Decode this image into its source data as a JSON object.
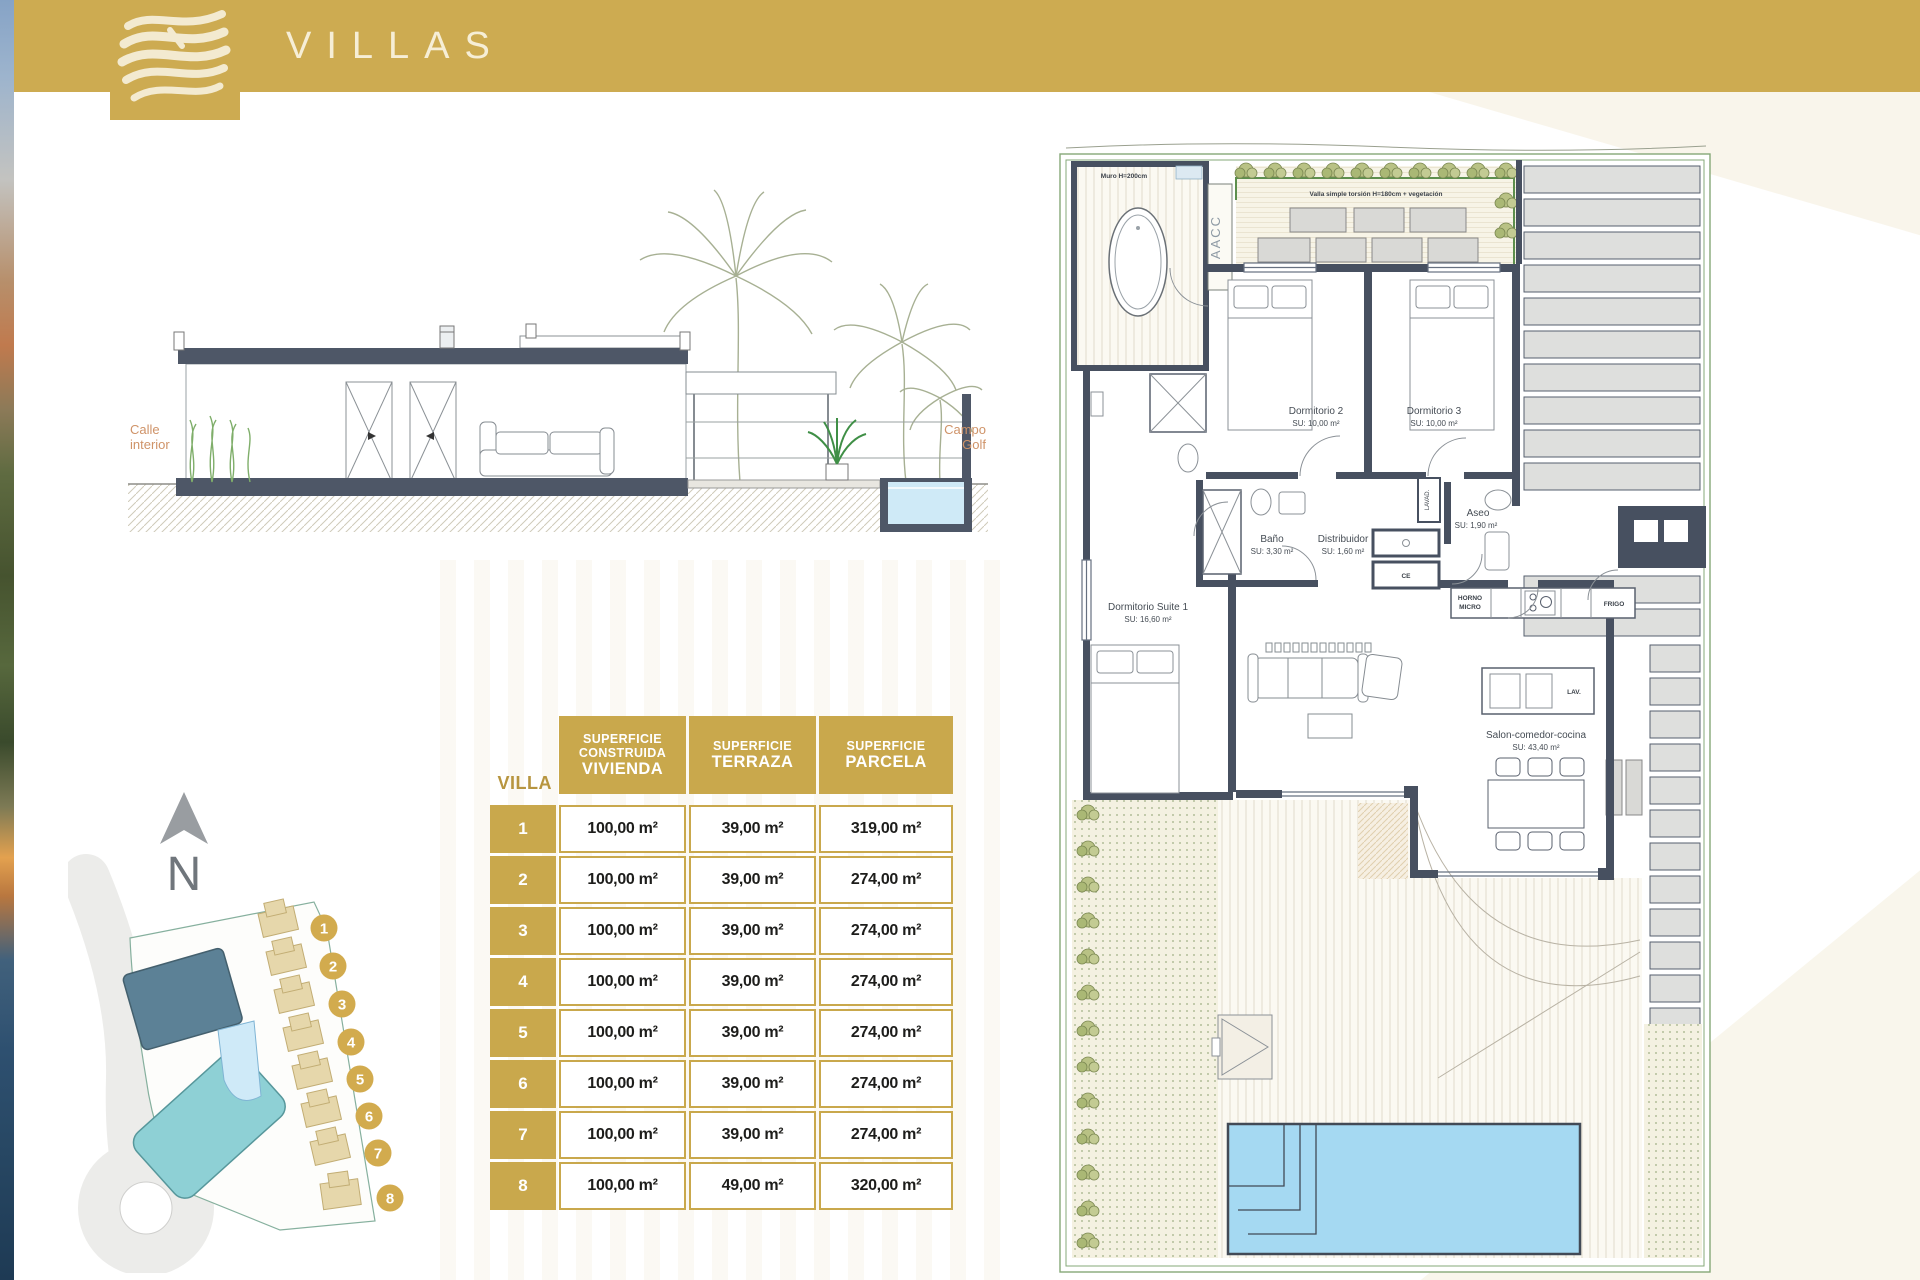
{
  "colors": {
    "gold": "#CDAB51",
    "table_gold": "#C9A84C",
    "wall_dark": "#475060",
    "pool_blue": "#A5D9F2",
    "fence_green": "#5D8F4D",
    "label_tan": "#CF9368",
    "site_building_dark": "#5C8196",
    "site_building_teal": "#8ED0D5",
    "villa_tan": "#E6D7AB"
  },
  "header": {
    "brand": "VILLAS"
  },
  "elevation": {
    "calle_l1": "Calle",
    "calle_l2": "interior",
    "campo_l1": "Campo",
    "campo_l2": "Golf"
  },
  "site_plan": {
    "north": "N",
    "plots": [
      "1",
      "2",
      "3",
      "4",
      "5",
      "6",
      "7",
      "8"
    ]
  },
  "table": {
    "villa_header": "VILLA",
    "col_vivienda": {
      "l1": "SUPERFICIE",
      "l2": "CONSTRUIDA",
      "l3": "VIVIENDA"
    },
    "col_terraza": {
      "l1": "SUPERFICIE",
      "l3": "TERRAZA"
    },
    "col_parcela": {
      "l1": "SUPERFICIE",
      "l3": "PARCELA"
    },
    "rows": [
      {
        "villa": "1",
        "vivienda": "100,00 m²",
        "terraza": "39,00 m²",
        "parcela": "319,00 m²"
      },
      {
        "villa": "2",
        "vivienda": "100,00 m²",
        "terraza": "39,00 m²",
        "parcela": "274,00 m²"
      },
      {
        "villa": "3",
        "vivienda": "100,00 m²",
        "terraza": "39,00 m²",
        "parcela": "274,00 m²"
      },
      {
        "villa": "4",
        "vivienda": "100,00 m²",
        "terraza": "39,00 m²",
        "parcela": "274,00 m²"
      },
      {
        "villa": "5",
        "vivienda": "100,00 m²",
        "terraza": "39,00 m²",
        "parcela": "274,00 m²"
      },
      {
        "villa": "6",
        "vivienda": "100,00 m²",
        "terraza": "39,00 m²",
        "parcela": "274,00 m²"
      },
      {
        "villa": "7",
        "vivienda": "100,00 m²",
        "terraza": "39,00 m²",
        "parcela": "274,00 m²"
      },
      {
        "villa": "8",
        "vivienda": "100,00 m²",
        "terraza": "49,00 m²",
        "parcela": "320,00 m²"
      }
    ]
  },
  "floor_plan": {
    "rooms": {
      "dorm2": {
        "name": "Dormitorio 2",
        "area": "SU: 10,00 m²"
      },
      "dorm3": {
        "name": "Dormitorio 3",
        "area": "SU: 10,00 m²"
      },
      "bano": {
        "name": "Baño",
        "area": "SU: 3,30 m²"
      },
      "distribuidor": {
        "name": "Distribuidor",
        "area": "SU: 1,60 m²"
      },
      "aseo": {
        "name": "Aseo",
        "area": "SU: 1,90 m²"
      },
      "suite": {
        "name": "Dormitorio Suite 1",
        "area": "SU: 16,60 m²"
      },
      "salon": {
        "name": "Salon-comedor-cocina",
        "area": "SU: 43,40 m²"
      }
    },
    "annotations": {
      "muro": "Muro H=200cm",
      "valla": "Valla simple torsión H=180cm + vegetación",
      "aacc": "AACC",
      "ce": "CE",
      "lavad": "LAVAD.",
      "horno_l1": "HORNO",
      "horno_l2": "MICRO",
      "frigo": "FRIGO",
      "lav": "LAV."
    }
  }
}
